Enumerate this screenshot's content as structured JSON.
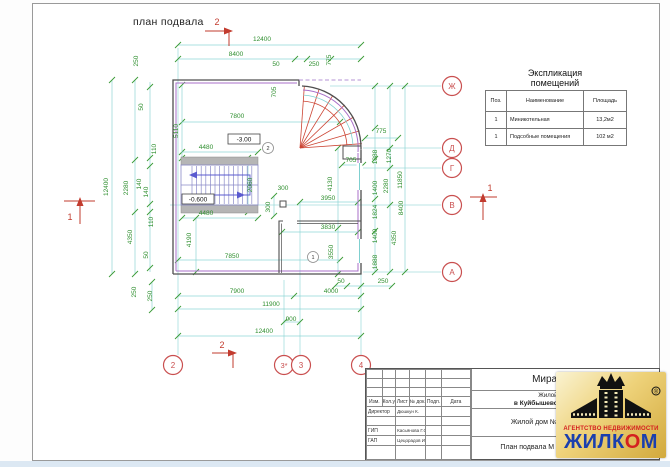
{
  "drawing": {
    "title": "план подвала"
  },
  "axes": {
    "bottom": [
      "2",
      "3*",
      "3",
      "4"
    ],
    "right": [
      "Ж",
      "Д",
      "Г",
      "В",
      "А"
    ]
  },
  "sections": [
    {
      "label": "2"
    },
    {
      "label": "2"
    },
    {
      "label": "1"
    },
    {
      "label": "1"
    }
  ],
  "rooms": [
    {
      "label": "1"
    },
    {
      "label": "2"
    }
  ],
  "elevations": [
    {
      "label": "-3.00"
    },
    {
      "label": "-0.600"
    }
  ],
  "dimensions": [
    {
      "t": "12400",
      "x": 262,
      "y": 41
    },
    {
      "t": "8400",
      "x": 236,
      "y": 56
    },
    {
      "t": "50",
      "x": 276,
      "y": 66
    },
    {
      "t": "250",
      "x": 314,
      "y": 66
    },
    {
      "t": "775",
      "x": 331,
      "y": 60,
      "r": 1
    },
    {
      "t": "705",
      "x": 276,
      "y": 92,
      "r": 1
    },
    {
      "t": "7800",
      "x": 237,
      "y": 118
    },
    {
      "t": "775",
      "x": 381,
      "y": 133
    },
    {
      "t": "705",
      "x": 351,
      "y": 162
    },
    {
      "t": "250",
      "x": 138,
      "y": 61,
      "r": 1
    },
    {
      "t": "50",
      "x": 143,
      "y": 107,
      "r": 1
    },
    {
      "t": "110",
      "x": 156,
      "y": 149,
      "r": 1
    },
    {
      "t": "140",
      "x": 141,
      "y": 184,
      "r": 1
    },
    {
      "t": "2280",
      "x": 128,
      "y": 188,
      "r": 1
    },
    {
      "t": "140",
      "x": 148,
      "y": 192,
      "r": 1
    },
    {
      "t": "110",
      "x": 153,
      "y": 222,
      "r": 1
    },
    {
      "t": "4350",
      "x": 132,
      "y": 237,
      "r": 1
    },
    {
      "t": "50",
      "x": 148,
      "y": 255,
      "r": 1
    },
    {
      "t": "250",
      "x": 136,
      "y": 292,
      "r": 1
    },
    {
      "t": "12400",
      "x": 108,
      "y": 187,
      "r": 1
    },
    {
      "t": "5110",
      "x": 178,
      "y": 131,
      "r": 1
    },
    {
      "t": "4480",
      "x": 206,
      "y": 149
    },
    {
      "t": "2060",
      "x": 252,
      "y": 185,
      "r": 1
    },
    {
      "t": "4480",
      "x": 206,
      "y": 215
    },
    {
      "t": "4190",
      "x": 191,
      "y": 240,
      "r": 1
    },
    {
      "t": "7850",
      "x": 232,
      "y": 258
    },
    {
      "t": "300",
      "x": 283,
      "y": 190
    },
    {
      "t": "300",
      "x": 270,
      "y": 207,
      "r": 1
    },
    {
      "t": "4130",
      "x": 332,
      "y": 184,
      "r": 1
    },
    {
      "t": "3950",
      "x": 328,
      "y": 200
    },
    {
      "t": "3830",
      "x": 328,
      "y": 229
    },
    {
      "t": "3550",
      "x": 333,
      "y": 252,
      "r": 1
    },
    {
      "t": "250",
      "x": 152,
      "y": 296,
      "r": 1
    },
    {
      "t": "7900",
      "x": 237,
      "y": 293
    },
    {
      "t": "4000",
      "x": 331,
      "y": 293
    },
    {
      "t": "50",
      "x": 341,
      "y": 283
    },
    {
      "t": "250",
      "x": 383,
      "y": 283
    },
    {
      "t": "11900",
      "x": 271,
      "y": 306
    },
    {
      "t": "900",
      "x": 291,
      "y": 321
    },
    {
      "t": "12400",
      "x": 264,
      "y": 333
    },
    {
      "t": "1888",
      "x": 377,
      "y": 157,
      "r": 1
    },
    {
      "t": "1270",
      "x": 391,
      "y": 156,
      "r": 1
    },
    {
      "t": "1400",
      "x": 377,
      "y": 188,
      "r": 1
    },
    {
      "t": "2280",
      "x": 388,
      "y": 186,
      "r": 1
    },
    {
      "t": "11850",
      "x": 402,
      "y": 180,
      "r": 1
    },
    {
      "t": "1824",
      "x": 377,
      "y": 212,
      "r": 1
    },
    {
      "t": "8400",
      "x": 403,
      "y": 208,
      "r": 1
    },
    {
      "t": "1400",
      "x": 377,
      "y": 236,
      "r": 1
    },
    {
      "t": "4350",
      "x": 396,
      "y": 238,
      "r": 1
    },
    {
      "t": "1888",
      "x": 377,
      "y": 262,
      "r": 1
    }
  ],
  "explication": {
    "title_line1": "Экспликация",
    "title_line2": "помещений",
    "headers": [
      "Поз.",
      "Наименование",
      "Площадь"
    ],
    "rows": [
      {
        "pos": "1",
        "name": "Миникотельная",
        "area": "13,2м2"
      },
      {
        "pos": "1",
        "name": "Подсобные помещения",
        "area": "102 м2"
      }
    ]
  },
  "title_block": {
    "columns": [
      "Изм.",
      "Кол.уч",
      "Лист",
      "№ док.",
      "Подп.",
      "Дата"
    ],
    "roles": [
      {
        "role": "Директор",
        "name": "Дюшкун К."
      },
      {
        "role": "ГИП",
        "name": "Касьянова Г.С."
      },
      {
        "role": "ГАП",
        "name": "Цецорадов И.А."
      }
    ],
    "project_title": "Мира-1",
    "project_line1": "Жилой дом п",
    "project_line2": "в Куйбышевском р",
    "object": "Жилой дом № 1",
    "sheet_name": "План подвала М 1:100"
  },
  "logo": {
    "line1": "АГЕНТСТВО НЕДВИЖИМОСТИ",
    "word_part1": "ЖИЛК",
    "word_part2": "О",
    "word_part3": "М",
    "registered": "®"
  }
}
